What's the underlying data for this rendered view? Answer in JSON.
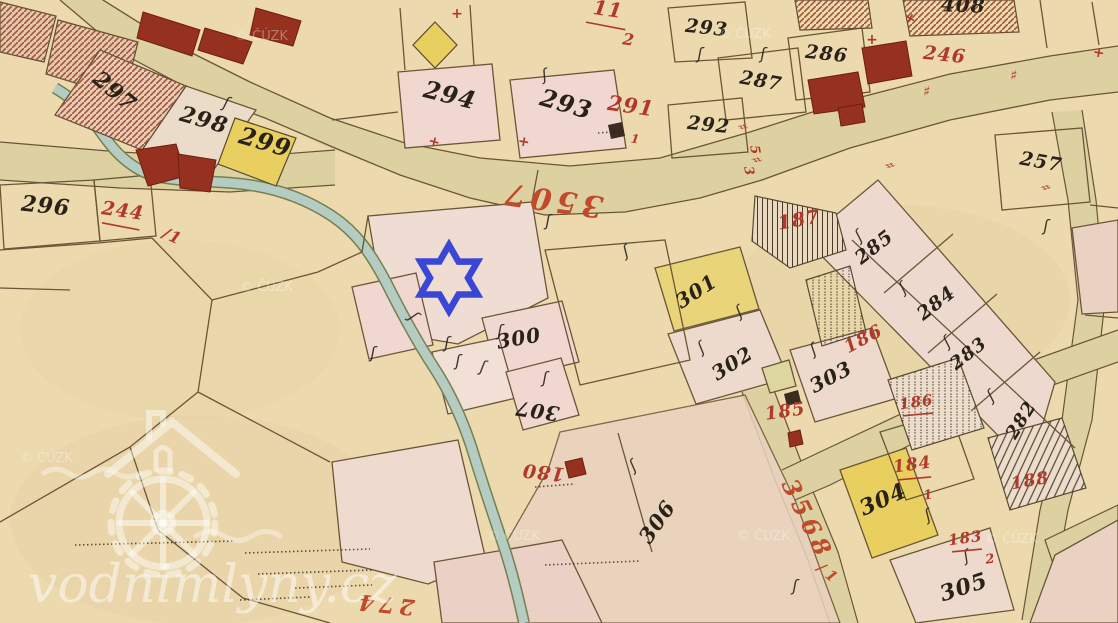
{
  "map": {
    "background_color": "#ecd9ad",
    "road_color": "#ded1a1",
    "stream_color": "#b4ccc1",
    "parcel_pink": "#f0d7cf",
    "parcel_yellow": "#e8cf5f",
    "label_black": "#292218",
    "label_red": "#b0392a",
    "star_marker": {
      "shape": "six-pointed-star-outline",
      "color": "#3a46d4"
    },
    "glyphs": {
      "hook": "ʃ",
      "cross": "+",
      "hash": "♯"
    },
    "black_labels": [
      {
        "t": "297",
        "x": 110,
        "y": 97,
        "r": 40,
        "s": 22
      },
      {
        "t": "298",
        "x": 202,
        "y": 127,
        "r": 16,
        "s": 22
      },
      {
        "t": "299",
        "x": 263,
        "y": 150,
        "r": 16,
        "s": 24
      },
      {
        "t": "296",
        "x": 45,
        "y": 213,
        "r": 6,
        "s": 22
      },
      {
        "t": "294",
        "x": 448,
        "y": 103,
        "r": 14,
        "s": 24
      },
      {
        "t": "293",
        "x": 564,
        "y": 112,
        "r": 16,
        "s": 24
      },
      {
        "t": "293",
        "x": 706,
        "y": 34,
        "r": 6,
        "s": 19
      },
      {
        "t": "292",
        "x": 708,
        "y": 131,
        "r": 6,
        "s": 19
      },
      {
        "t": "287",
        "x": 760,
        "y": 87,
        "r": 10,
        "s": 19
      },
      {
        "t": "286",
        "x": 826,
        "y": 60,
        "r": 6,
        "s": 19
      },
      {
        "t": "408",
        "x": 963,
        "y": 12,
        "r": 2,
        "s": 20
      },
      {
        "t": "257",
        "x": 1040,
        "y": 168,
        "r": 10,
        "s": 19
      },
      {
        "t": "285",
        "x": 878,
        "y": 252,
        "r": -38,
        "s": 19
      },
      {
        "t": "284",
        "x": 940,
        "y": 308,
        "r": -38,
        "s": 19
      },
      {
        "t": "283",
        "x": 972,
        "y": 358,
        "r": -38,
        "s": 18
      },
      {
        "t": "282",
        "x": 1026,
        "y": 423,
        "r": -58,
        "s": 18
      },
      {
        "t": "301",
        "x": 700,
        "y": 297,
        "r": -33,
        "s": 20
      },
      {
        "t": "302",
        "x": 736,
        "y": 369,
        "r": -33,
        "s": 20
      },
      {
        "t": "303",
        "x": 834,
        "y": 383,
        "r": -28,
        "s": 20
      },
      {
        "t": "300",
        "x": 520,
        "y": 345,
        "r": -10,
        "s": 20
      },
      {
        "t": "307",
        "x": 538,
        "y": 404,
        "r": 188,
        "s": 20
      },
      {
        "t": "306",
        "x": 663,
        "y": 526,
        "r": -55,
        "s": 21
      },
      {
        "t": "304",
        "x": 886,
        "y": 506,
        "r": -24,
        "s": 22
      },
      {
        "t": "305",
        "x": 966,
        "y": 594,
        "r": -18,
        "s": 22
      }
    ],
    "red_labels": [
      {
        "t": "3507",
        "x": 553,
        "y": 190,
        "r": 188,
        "s": 30,
        "c": "road"
      },
      {
        "t": "3568",
        "x": 800,
        "y": 523,
        "r": 64,
        "s": 24,
        "c": "road"
      },
      {
        "t": "/1",
        "x": 826,
        "y": 578,
        "r": 40,
        "s": 15,
        "c": "road"
      },
      {
        "t": "274",
        "x": 385,
        "y": 597,
        "r": 186,
        "s": 22,
        "c": "road"
      },
      {
        "t": "244",
        "x": 122,
        "y": 217,
        "r": 8,
        "s": 19,
        "u": 1
      },
      {
        "t": "/1",
        "x": 170,
        "y": 241,
        "r": 25,
        "s": 16
      },
      {
        "t": "11",
        "x": 607,
        "y": 16,
        "r": 8,
        "s": 20,
        "u": 1
      },
      {
        "t": "2",
        "x": 628,
        "y": 45,
        "r": 8,
        "s": 16
      },
      {
        "t": "291",
        "x": 630,
        "y": 113,
        "r": 8,
        "s": 21
      },
      {
        "t": "1",
        "x": 635,
        "y": 143,
        "r": 8,
        "s": 12
      },
      {
        "t": "246",
        "x": 944,
        "y": 61,
        "r": 6,
        "s": 19
      },
      {
        "t": "187",
        "x": 800,
        "y": 226,
        "r": -10,
        "s": 19
      },
      {
        "t": "186",
        "x": 866,
        "y": 344,
        "r": -28,
        "s": 18
      },
      {
        "t": "186",
        "x": 917,
        "y": 407,
        "r": -8,
        "s": 15,
        "u": 1
      },
      {
        "t": "185",
        "x": 786,
        "y": 417,
        "r": -8,
        "s": 18
      },
      {
        "t": "184",
        "x": 913,
        "y": 470,
        "r": -8,
        "s": 17,
        "u": 1
      },
      {
        "t": "1",
        "x": 929,
        "y": 499,
        "r": -8,
        "s": 13
      },
      {
        "t": "188",
        "x": 1031,
        "y": 486,
        "r": -10,
        "s": 17
      },
      {
        "t": "183",
        "x": 966,
        "y": 543,
        "r": -8,
        "s": 15,
        "u": 1
      },
      {
        "t": "2",
        "x": 991,
        "y": 563,
        "r": -8,
        "s": 13
      },
      {
        "t": "180",
        "x": 544,
        "y": 466,
        "r": 186,
        "s": 19
      },
      {
        "t": "5",
        "x": 751,
        "y": 151,
        "r": 80,
        "s": 13
      },
      {
        "t": "3",
        "x": 745,
        "y": 172,
        "r": 80,
        "s": 13
      }
    ],
    "red_marks": [
      {
        "t": "+",
        "x": 433,
        "y": 146,
        "r": 15
      },
      {
        "t": "+",
        "x": 523,
        "y": 146,
        "r": 10
      },
      {
        "t": "♯",
        "x": 738,
        "y": 128,
        "r": 78
      },
      {
        "t": "♯",
        "x": 752,
        "y": 161,
        "r": 78
      },
      {
        "t": "♯",
        "x": 885,
        "y": 167,
        "r": 72
      },
      {
        "t": "♯",
        "x": 926,
        "y": 96,
        "r": 8
      },
      {
        "t": "♯",
        "x": 1013,
        "y": 80,
        "r": 8
      },
      {
        "t": "♯",
        "x": 1041,
        "y": 189,
        "r": 72
      },
      {
        "t": "+",
        "x": 1098,
        "y": 57,
        "r": 10
      },
      {
        "t": "+",
        "x": 908,
        "y": 22,
        "r": 30
      },
      {
        "t": "+",
        "x": 872,
        "y": 44,
        "r": 0
      },
      {
        "t": "+",
        "x": 457,
        "y": 18,
        "r": 0
      }
    ],
    "hook_marks": [
      {
        "x": 546,
        "y": 80,
        "r": -15
      },
      {
        "x": 628,
        "y": 256,
        "r": -25
      },
      {
        "x": 458,
        "y": 366,
        "r": 0
      },
      {
        "x": 500,
        "y": 336,
        "r": 0
      },
      {
        "x": 545,
        "y": 383,
        "r": 0
      },
      {
        "x": 410,
        "y": 320,
        "r": 45
      },
      {
        "x": 373,
        "y": 358,
        "r": 0
      },
      {
        "x": 447,
        "y": 348,
        "r": 0
      },
      {
        "x": 482,
        "y": 372,
        "r": 10
      },
      {
        "x": 636,
        "y": 470,
        "r": -35
      },
      {
        "x": 795,
        "y": 591,
        "r": 0
      },
      {
        "x": 862,
        "y": 240,
        "r": -38
      },
      {
        "x": 906,
        "y": 292,
        "r": -38
      },
      {
        "x": 950,
        "y": 346,
        "r": -38
      },
      {
        "x": 994,
        "y": 400,
        "r": -38
      },
      {
        "x": 742,
        "y": 316,
        "r": -33
      },
      {
        "x": 704,
        "y": 352,
        "r": -33
      },
      {
        "x": 816,
        "y": 354,
        "r": -30
      },
      {
        "x": 930,
        "y": 520,
        "r": -25
      },
      {
        "x": 968,
        "y": 561,
        "r": -20
      },
      {
        "x": 1046,
        "y": 231,
        "r": 0
      },
      {
        "x": 700,
        "y": 59,
        "r": 0
      },
      {
        "x": 763,
        "y": 59,
        "r": 0
      },
      {
        "x": 225,
        "y": 108,
        "r": 15
      },
      {
        "x": 548,
        "y": 226,
        "r": 0
      }
    ],
    "dotted_lines": [
      {
        "x1": 75,
        "y1": 545,
        "x2": 235,
        "y2": 541
      },
      {
        "x1": 245,
        "y1": 553,
        "x2": 370,
        "y2": 549
      },
      {
        "x1": 258,
        "y1": 574,
        "x2": 372,
        "y2": 570
      },
      {
        "x1": 295,
        "y1": 588,
        "x2": 372,
        "y2": 585
      },
      {
        "x1": 240,
        "y1": 600,
        "x2": 310,
        "y2": 597
      },
      {
        "x1": 545,
        "y1": 565,
        "x2": 640,
        "y2": 561
      },
      {
        "x1": 535,
        "y1": 487,
        "x2": 575,
        "y2": 484
      },
      {
        "x1": 598,
        "y1": 133,
        "x2": 625,
        "y2": 131
      }
    ],
    "watermark": {
      "site": "vodnimlyny.cz",
      "copyright": "© ČÚZK",
      "copyright_positions": [
        {
          "x": 235,
          "y": 40
        },
        {
          "x": 718,
          "y": 38
        },
        {
          "x": 240,
          "y": 291
        },
        {
          "x": 487,
          "y": 540
        },
        {
          "x": 737,
          "y": 540
        },
        {
          "x": 985,
          "y": 543
        },
        {
          "x": 20,
          "y": 462
        }
      ]
    }
  }
}
